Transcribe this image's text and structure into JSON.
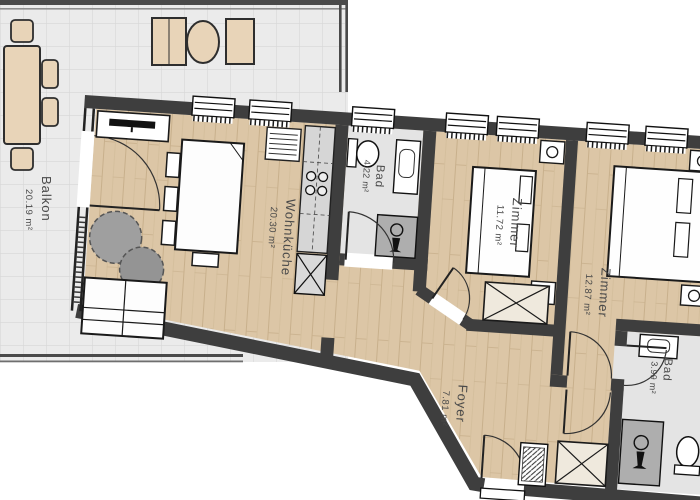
{
  "plan": {
    "title": "Apartment floor plan",
    "rooms": [
      {
        "name": "Balkon",
        "area": "20.19 m²"
      },
      {
        "name": "Wohnküche",
        "area": "20.30 m²"
      },
      {
        "name": "Bad",
        "area": "4.22 m²"
      },
      {
        "name": "Zimmer",
        "area": "11.72 m²"
      },
      {
        "name": "Zimmer",
        "area": "12.87 m²"
      },
      {
        "name": "Foyer",
        "area": "7.81 m²"
      },
      {
        "name": "Bad",
        "area": "3.99 m²"
      }
    ],
    "colors": {
      "wall": "#3e3e3e",
      "wood_floor": "#dcc6a6",
      "tile_floor": "#ebebeb",
      "bath_floor": "#e4e4e4",
      "shower": "#aeaeae",
      "furniture": "#ffffff",
      "balcony_furniture": "#e8d4b8",
      "outline": "#1a1a1a",
      "label_text": "#4a4a4a"
    }
  }
}
